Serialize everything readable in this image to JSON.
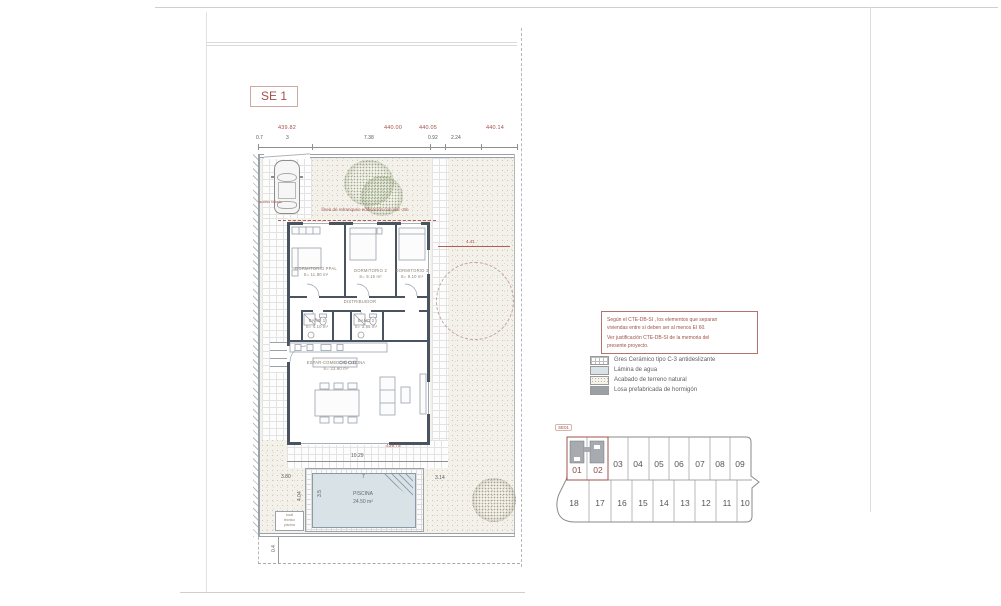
{
  "sheet": {
    "label": "SE 1",
    "keyplan_tag": "SE01"
  },
  "site": {
    "setback_note": "línea de retranqueo edificación con vial -3m",
    "access_note": "acceso rodado",
    "elevations": {
      "street_1": "439.82",
      "street_2": "440.00",
      "street_3": "440.05",
      "street_4": "440.14",
      "terrace": "439.75"
    },
    "dimensions": {
      "plot_left": "0.7",
      "carport": "3",
      "front_1": "7.38",
      "front_2": "0.92",
      "front_3": "2.24",
      "terrace_width": "10.29",
      "pool_width": "7",
      "pool_length": "4.04",
      "pool_inner": "3.5",
      "pool_gap_left": "3.80",
      "pool_gap_right": "3.14",
      "street_offset": "0.4",
      "tree": "4.41"
    },
    "pool": {
      "name": "PISCINA",
      "area": "24.50 m²"
    },
    "tech_box": [
      "local",
      "técnico",
      "piscina"
    ]
  },
  "rooms": {
    "master": {
      "name": "DORMITORIO PPAL",
      "area": "S= 11.80 m²"
    },
    "bedroom2": {
      "name": "DORMITORIO 2",
      "area": "S= 9.15 m²"
    },
    "bedroom3": {
      "name": "DORMITORIO 3",
      "area": "S= 9.10 m²"
    },
    "hall": {
      "name": "DISTRIBUIDOR"
    },
    "bath1": {
      "name": "BAÑO 1",
      "area": "S= 4.10 m²"
    },
    "bath2": {
      "name": "BAÑO 2",
      "area": "S= 3.85 m²"
    },
    "living": {
      "name": "ESTAR-COMEDOR-COCINA",
      "area": "S= 33.90 m²"
    }
  },
  "note_box": {
    "line1": "Según el CTE-DB-SI , los elementos que separan",
    "line2": "viviendas entre sí deben ser al menos EI 60.",
    "line3": "Ver justificación CTE-DB-SI de la memoria del",
    "line4": "presente proyecto."
  },
  "legend": {
    "items": [
      {
        "label": "Gres Cerámico tipo C-3 antideslizante",
        "swatch": "grid"
      },
      {
        "label": "Lámina de agua",
        "swatch": "water"
      },
      {
        "label": "Acabado de terreno natural",
        "swatch": "stipple"
      },
      {
        "label": "Losa prefabricada de hormigón",
        "swatch": "solid"
      }
    ]
  },
  "keyplan": {
    "top_row": [
      "01",
      "02",
      "03",
      "04",
      "05",
      "06",
      "07",
      "08",
      "09"
    ],
    "bottom_row": [
      "18",
      "17",
      "16",
      "15",
      "14",
      "13",
      "12",
      "11",
      "10"
    ],
    "highlighted": "01 02"
  },
  "colors": {
    "accent_red": "#a0524a",
    "wall": "#4a5460",
    "water": "#d8e2e7"
  }
}
